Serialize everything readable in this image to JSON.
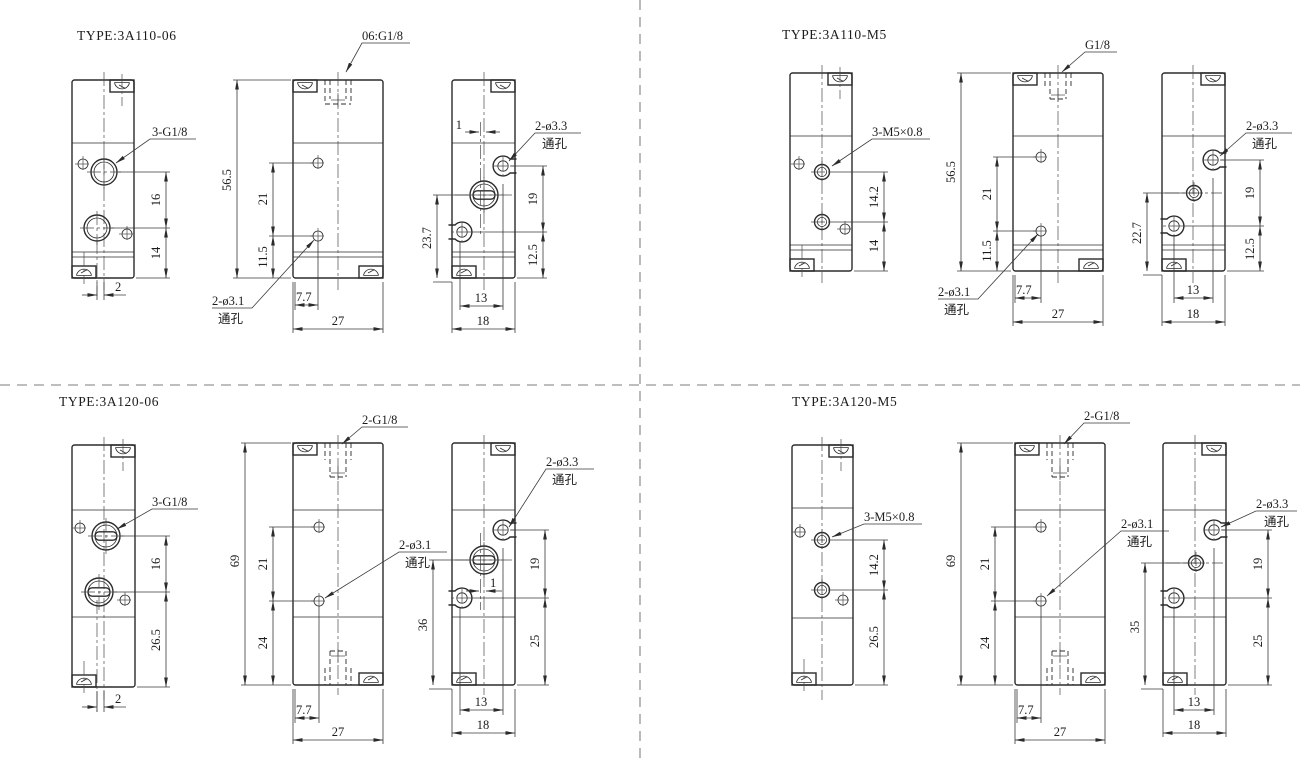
{
  "colors": {
    "line": "#2b2b2b",
    "dim_line": "#3a3a3a",
    "divider": "#a9a9a9",
    "background": "#ffffff"
  },
  "quadrants": [
    {
      "title": "TYPE:3A110-06",
      "front": {
        "callout": "3-G1/8",
        "dim_spacing": "16",
        "dim_bottom": "14",
        "dim_offset": "2"
      },
      "middle": {
        "callout_top": "06:G1/8",
        "dim_height": "56.5",
        "dim_spacing": "21",
        "dim_bottom": "11.5",
        "hole_callout_line1": "2-ø3.1",
        "hole_callout_line2": "通孔",
        "dim_x": "7.7",
        "dim_width": "27"
      },
      "side": {
        "hole_callout_line1": "2-ø3.3",
        "hole_callout_line2": "通孔",
        "dim_offset": "1",
        "dim_upper": "19",
        "dim_lower": "12.5",
        "dim_left": "23.7",
        "dim_x": "13",
        "dim_width": "18"
      }
    },
    {
      "title": "TYPE:3A110-M5",
      "front": {
        "callout": "3-M5×0.8",
        "dim_spacing": "14.2",
        "dim_bottom": "14"
      },
      "middle": {
        "callout_top": "G1/8",
        "dim_height": "56.5",
        "dim_spacing": "21",
        "dim_bottom": "11.5",
        "hole_callout_line1": "2-ø3.1",
        "hole_callout_line2": "通孔",
        "dim_x": "7.7",
        "dim_width": "27"
      },
      "side": {
        "hole_callout_line1": "2-ø3.3",
        "hole_callout_line2": "通孔",
        "dim_upper": "19",
        "dim_lower": "12.5",
        "dim_left": "22.7",
        "dim_x": "13",
        "dim_width": "18"
      }
    },
    {
      "title": "TYPE:3A120-06",
      "front": {
        "callout": "3-G1/8",
        "dim_spacing": "16",
        "dim_bottom": "26.5",
        "dim_offset": "2"
      },
      "middle": {
        "callout_top": "2-G1/8",
        "dim_height": "69",
        "dim_spacing": "21",
        "dim_bottom": "24",
        "hole_callout_line1": "2-ø3.1",
        "hole_callout_line2": "通孔",
        "dim_x": "7.7",
        "dim_width": "27"
      },
      "side": {
        "hole_callout_line1": "2-ø3.3",
        "hole_callout_line2": "通孔",
        "dim_offset": "1",
        "dim_upper": "19",
        "dim_lower": "25",
        "dim_left": "36",
        "dim_x": "13",
        "dim_width": "18"
      }
    },
    {
      "title": "TYPE:3A120-M5",
      "front": {
        "callout": "3-M5×0.8",
        "dim_spacing": "14.2",
        "dim_bottom": "26.5"
      },
      "middle": {
        "callout_top": "2-G1/8",
        "dim_height": "69",
        "dim_spacing": "21",
        "dim_bottom": "24",
        "hole_callout_line1": "2-ø3.1",
        "hole_callout_line2": "通孔",
        "dim_x": "7.7",
        "dim_width": "27"
      },
      "side": {
        "hole_callout_line1": "2-ø3.3",
        "hole_callout_line2": "通孔",
        "dim_upper": "19",
        "dim_lower": "25",
        "dim_left": "35",
        "dim_x": "13",
        "dim_width": "18"
      }
    }
  ]
}
